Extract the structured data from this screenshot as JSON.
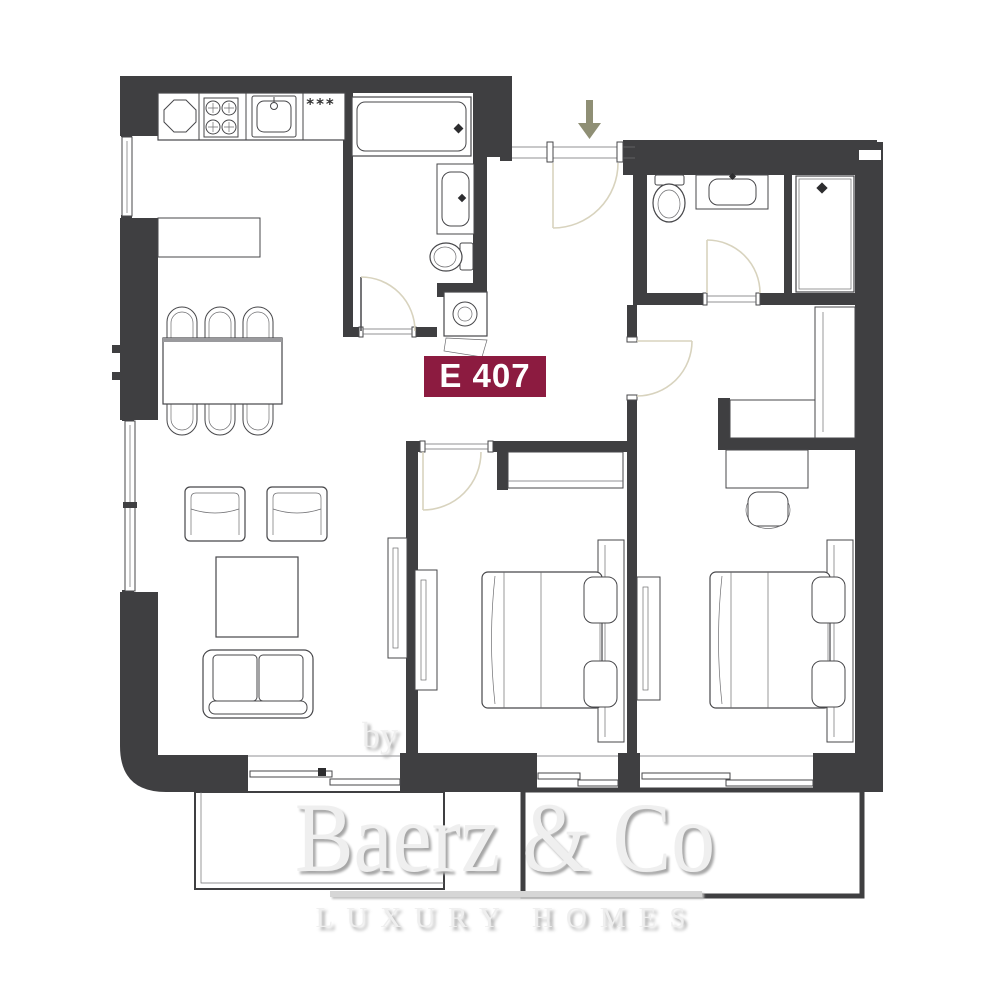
{
  "unit": {
    "label": "E 407"
  },
  "kitchen": {
    "appliance_marks": "***"
  },
  "watermark": {
    "prefix": "by",
    "brand": "Baerz & Co",
    "tagline": "LUXURY HOMES"
  },
  "icons": {
    "entrance_arrow": "down-arrow",
    "fixtures": [
      "stove",
      "kitchen-sink",
      "bathtub",
      "vanity-sink",
      "toilet",
      "washing-machine",
      "shower"
    ]
  },
  "colors": {
    "wall": "#3f3f41",
    "unit_label_bg": "#8c1b40",
    "unit_label_text": "#ffffff",
    "door_swing": "#d8d3be",
    "entrance_arrow": "#8f8f75",
    "furniture_line": "#47474a",
    "watermark_text": "#efefef"
  }
}
